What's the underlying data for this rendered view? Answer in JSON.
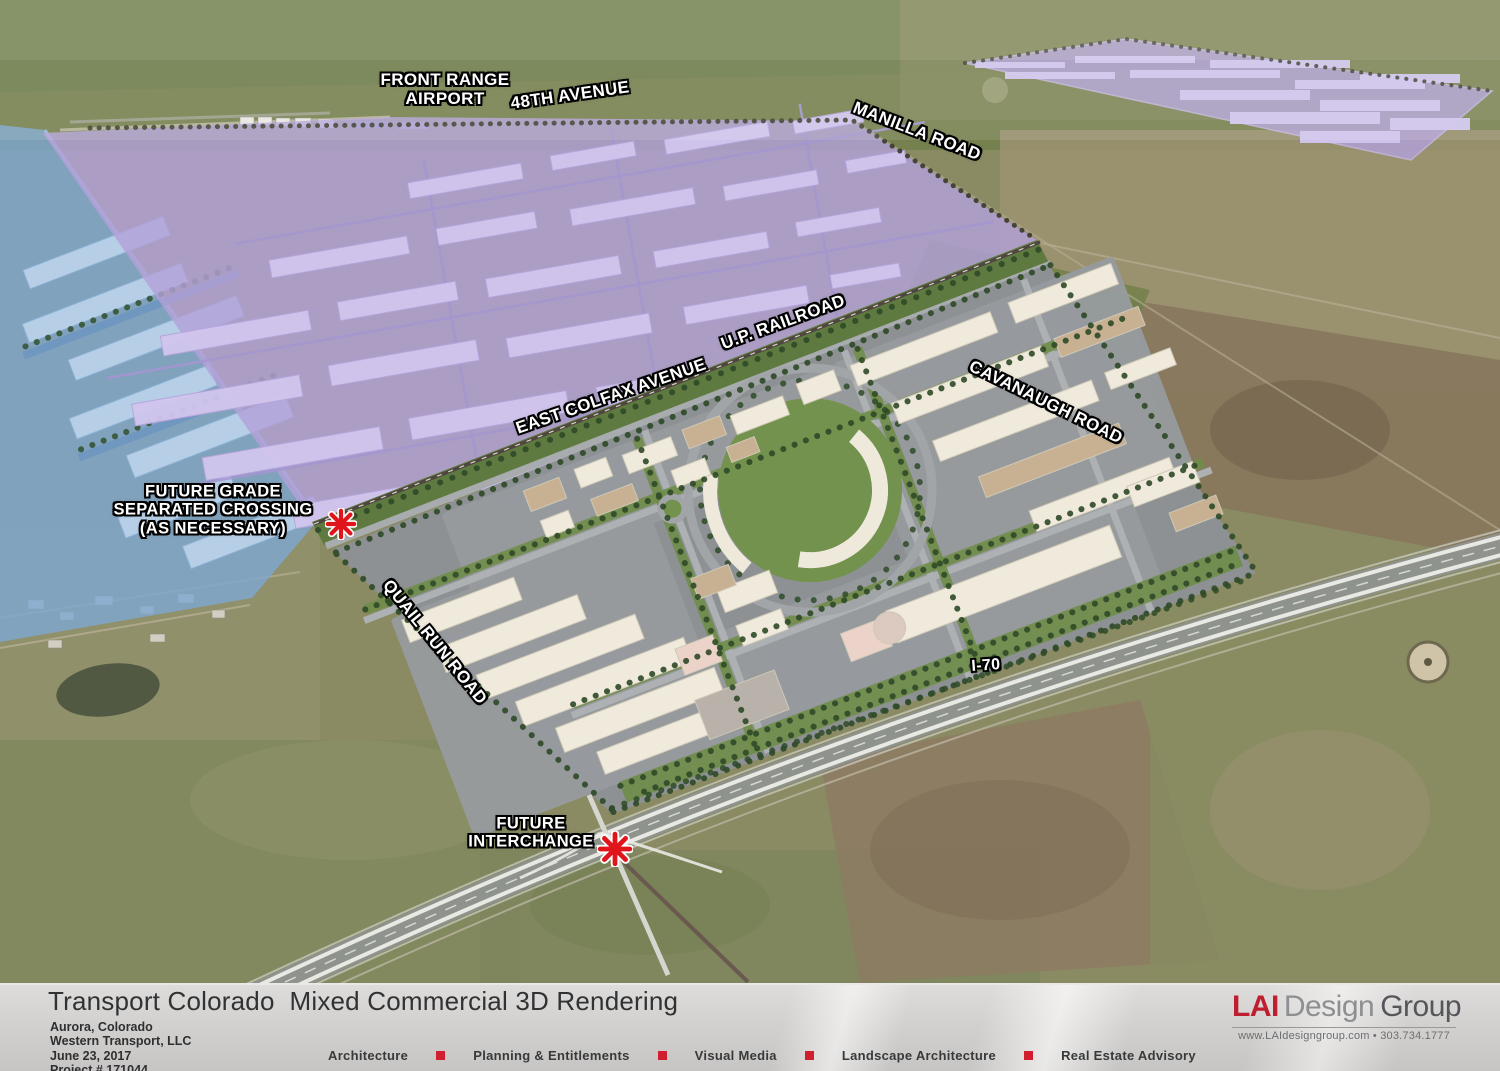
{
  "scene_labels": {
    "airport_line1": "FRONT RANGE",
    "airport_line2": "AIRPORT",
    "avenue_48th": "48TH AVENUE",
    "manilla_road": "MANILLA ROAD",
    "up_railroad": "U.P. RAILROAD",
    "east_colfax": "EAST COLFAX AVENUE",
    "cavanaugh_road": "CAVANAUGH ROAD",
    "quail_run_road": "QUAIL RUN ROAD",
    "i70": "I-70",
    "crossing_line1": "FUTURE GRADE",
    "crossing_line2": "SEPARATED CROSSING",
    "crossing_line3": "(AS NECESSARY)",
    "interchange_line1": "FUTURE",
    "interchange_line2": "INTERCHANGE"
  },
  "title_bar": {
    "title": "Transport Colorado  Mixed Commercial 3D Rendering",
    "location": "Aurora, Colorado",
    "client": "Western Transport, LLC",
    "date": "June 23, 2017",
    "project_number": "Project # 171044",
    "services": [
      "Architecture",
      "Planning & Entitlements",
      "Visual Media",
      "Landscape Architecture",
      "Real Estate Advisory"
    ]
  },
  "logo": {
    "part1": "LAI",
    "part2": "Design",
    "part3": "Group",
    "contact": "www.LAIdesigngroup.com  •  303.734.1777"
  },
  "colors": {
    "zone_purple": "#b2a1d8",
    "zone_blue": "#7ea8d2",
    "marker_red": "#e0151b",
    "brand_red": "#be1e2d",
    "accent_square_red": "#d01f2f"
  }
}
